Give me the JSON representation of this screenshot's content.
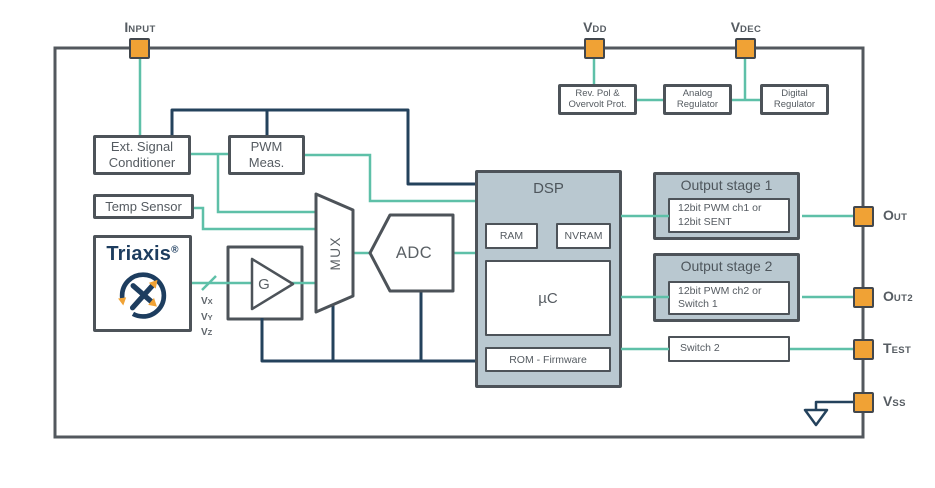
{
  "colors": {
    "navy": "#24425c",
    "teal": "#5ec0a8",
    "orange": "#f0a235",
    "border_dark": "#4d5359",
    "block_fill": "#b9c8d0",
    "text_gray": "#555b61",
    "logo_navy": "#1d3d5f",
    "outline_gray": "#53585e"
  },
  "pins": {
    "input": {
      "main": "I",
      "sub": "NPUT"
    },
    "vdd": {
      "main": "V",
      "sub": "DD"
    },
    "vdec": {
      "main": "V",
      "sub": "DEC"
    },
    "out": {
      "main": "O",
      "sub": "UT"
    },
    "out2": {
      "main": "O",
      "sub": "UT2"
    },
    "test": {
      "main": "T",
      "sub": "EST"
    },
    "vss": {
      "main": "V",
      "sub": "SS"
    }
  },
  "blocks": {
    "rev_pol": {
      "line1": "Rev. Pol &",
      "line2": "Overvolt Prot."
    },
    "analog_reg": {
      "line1": "Analog",
      "line2": "Regulator"
    },
    "digital_reg": {
      "line1": "Digital",
      "line2": "Regulator"
    },
    "ext_signal": {
      "line1": "Ext. Signal",
      "line2": "Conditioner"
    },
    "pwm_meas": {
      "line1": "PWM",
      "line2": "Meas."
    },
    "temp_sensor": {
      "label": "Temp Sensor"
    },
    "triaxis": {
      "brand": "Triaxis",
      "reg_mark": "®"
    },
    "gain": {
      "label": "G"
    },
    "mux": {
      "label": "MUX"
    },
    "adc": {
      "label": "ADC"
    },
    "dsp": {
      "title": "DSP",
      "ram": "RAM",
      "nvram": "NVRAM",
      "uc": "µC",
      "rom": "ROM - Firmware"
    },
    "output_stage1": {
      "title": "Output stage 1",
      "line1": "12bit PWM ch1 or",
      "line2": "12bit SENT"
    },
    "output_stage2": {
      "title": "Output stage 2",
      "line1": "12bit PWM ch2 or",
      "line2": "Switch 1"
    },
    "switch2": {
      "label": "Switch 2"
    }
  },
  "signals": {
    "vx": {
      "main": "V",
      "sub": "X"
    },
    "vy": {
      "main": "V",
      "sub": "Y"
    },
    "vz": {
      "main": "V",
      "sub": "Z"
    }
  }
}
